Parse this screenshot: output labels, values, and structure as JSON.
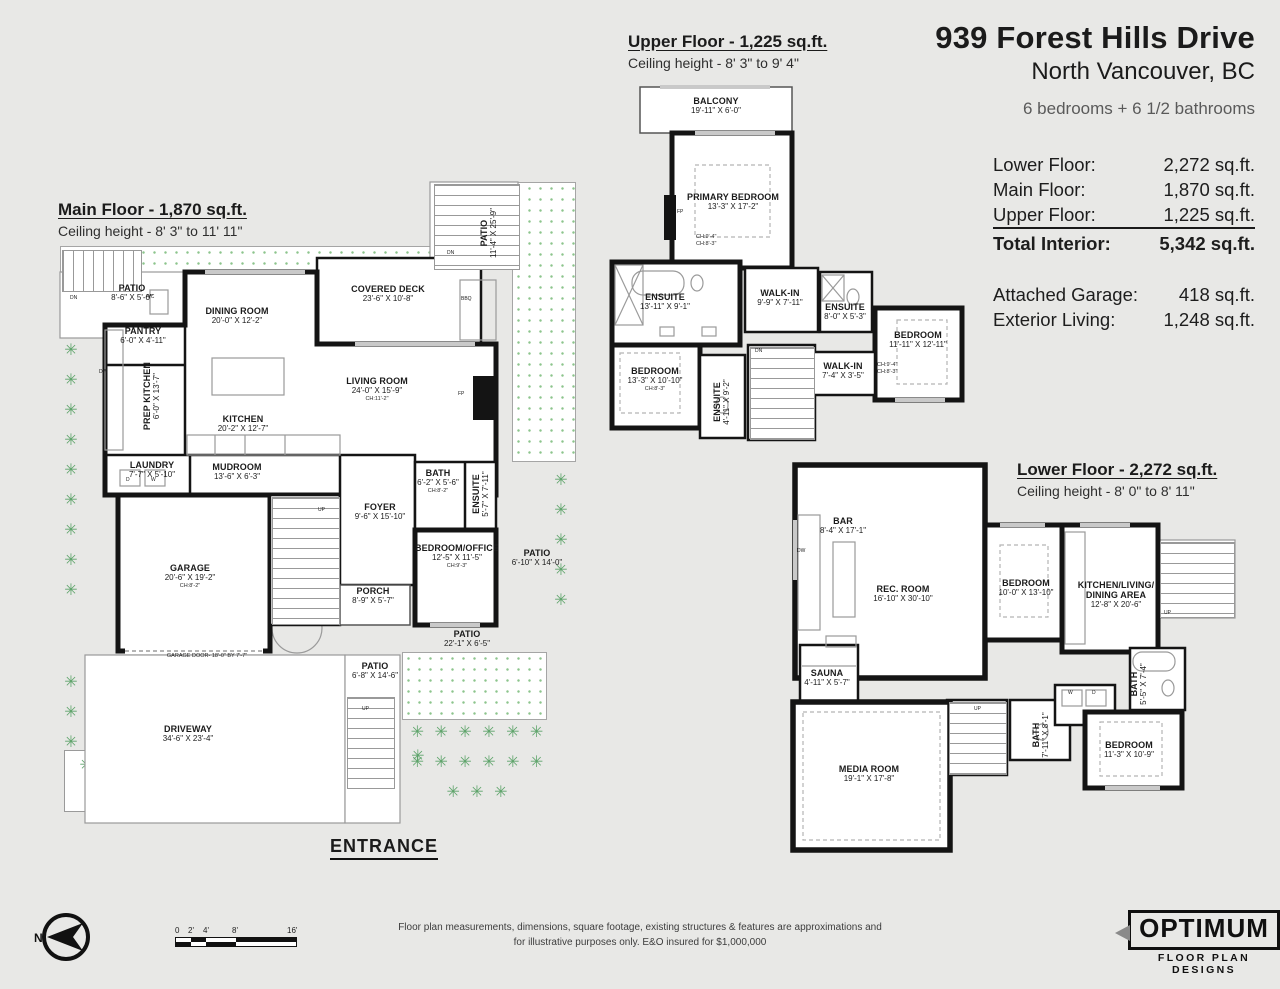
{
  "title": {
    "address": "939 Forest Hills Drive",
    "city": "North Vancouver, BC",
    "summary": "6 bedrooms + 6 1/2 bathrooms"
  },
  "area_table": {
    "rows": [
      {
        "label": "Lower Floor:",
        "value": "2,272 sq.ft."
      },
      {
        "label": "Main Floor:",
        "value": "1,870 sq.ft."
      },
      {
        "label": "Upper Floor:",
        "value": "1,225 sq.ft."
      }
    ],
    "total": {
      "label": "Total Interior:",
      "value": "5,342 sq.ft."
    },
    "extras": [
      {
        "label": "Attached Garage:",
        "value": "418 sq.ft."
      },
      {
        "label": "Exterior Living:",
        "value": "1,248 sq.ft."
      }
    ]
  },
  "floors": {
    "main": {
      "heading": "Main Floor - 1,870 sq.ft.",
      "ceiling": "Ceiling height - 8' 3\" to 11' 11\"",
      "entrance": "ENTRANCE",
      "notes": {
        "garage_door": "GARAGE DOOR- 18'-0\" BY 7'-7\""
      },
      "rooms": [
        {
          "name": "PATIO",
          "dims": "8'-6\" X 5'-0\""
        },
        {
          "name": "DINING ROOM",
          "dims": "20'-0\" X 12'-2\""
        },
        {
          "name": "COVERED DECK",
          "dims": "23'-6\" X 10'-8\""
        },
        {
          "name": "PANTRY",
          "dims": "6'-0\" X 4'-11\""
        },
        {
          "name": "PREP KITCHEN",
          "dims": "6'-0\" X 13'-7\""
        },
        {
          "name": "KITCHEN",
          "dims": "20'-2\" X 12'-7\""
        },
        {
          "name": "LIVING ROOM",
          "dims": "24'-0\" X 15'-9\"",
          "ch": "CH:11'-2\""
        },
        {
          "name": "PATIO",
          "dims": "11'-4\" X 25'-9\""
        },
        {
          "name": "LAUNDRY",
          "dims": "7'-7\" X 5'-10\""
        },
        {
          "name": "MUDROOM",
          "dims": "13'-6\" X 6'-3\""
        },
        {
          "name": "BATH",
          "dims": "6'-2\" X 5'-6\"",
          "ch": "CH:8'-2\""
        },
        {
          "name": "ENSUITE",
          "dims": "5'-7\" X 7'-11\""
        },
        {
          "name": "FOYER",
          "dims": "9'-6\" X 15'-10\""
        },
        {
          "name": "GARAGE",
          "dims": "20'-6\" X 19'-2\"",
          "ch": "CH:8'-2\""
        },
        {
          "name": "BEDROOM/OFFICE",
          "dims": "12'-5\" X 11'-5\"",
          "ch": "CH:9'-3\""
        },
        {
          "name": "PATIO",
          "dims": "6'-10\" X 14'-0\""
        },
        {
          "name": "PORCH",
          "dims": "8'-9\" X 5'-7\""
        },
        {
          "name": "PATIO",
          "dims": "22'-1\" X 6'-5\""
        },
        {
          "name": "PATIO",
          "dims": "6'-8\" X 14'-6\""
        },
        {
          "name": "DRIVEWAY",
          "dims": "34'-6\" X 23'-4\""
        }
      ]
    },
    "upper": {
      "heading": "Upper Floor - 1,225 sq.ft.",
      "ceiling": "Ceiling height - 8' 3\" to 9' 4\"",
      "rooms": [
        {
          "name": "BALCONY",
          "dims": "19'-11\" X 6'-0\""
        },
        {
          "name": "PRIMARY BEDROOM",
          "dims": "13'-3\" X 17'-2\"",
          "ch": "CH:9'-4\"",
          "ch2": "CH:8'-3\""
        },
        {
          "name": "ENSUITE",
          "dims": "13'-11\" X 9'-1\""
        },
        {
          "name": "WALK-IN",
          "dims": "9'-9\" X 7'-11\""
        },
        {
          "name": "ENSUITE",
          "dims": "8'-0\" X 5'-3\""
        },
        {
          "name": "BEDROOM",
          "dims": "11'-11\" X 12'-11\"",
          "ch": "CH:9'-4\"",
          "ch2": "CH:8'-3\""
        },
        {
          "name": "BEDROOM",
          "dims": "13'-3\" X 10'-10\"",
          "ch": "CH:8'-3\""
        },
        {
          "name": "ENSUITE",
          "dims": "4'-11\" X 9'-2\""
        },
        {
          "name": "WALK-IN",
          "dims": "7'-4\" X 3'-5\""
        }
      ]
    },
    "lower": {
      "heading": "Lower Floor - 2,272 sq.ft.",
      "ceiling": "Ceiling height - 8' 0\" to 8' 11\"",
      "rooms": [
        {
          "name": "BAR",
          "dims": "8'-4\" X 17'-1\""
        },
        {
          "name": "REC. ROOM",
          "dims": "16'-10\" X 30'-10\""
        },
        {
          "name": "BEDROOM",
          "dims": "10'-0\" X 13'-10\""
        },
        {
          "name": "KITCHEN/LIVING/ DINING AREA",
          "dims": "12'-8\" X 20'-6\""
        },
        {
          "name": "SAUNA",
          "dims": "4'-11\" X 5'-7\""
        },
        {
          "name": "BATH",
          "dims": "7'-11\" X 8'-1\""
        },
        {
          "name": "BATH",
          "dims": "5'-5\" X 7'-4\""
        },
        {
          "name": "BEDROOM",
          "dims": "11'-3\" X 10'-9\""
        },
        {
          "name": "MEDIA ROOM",
          "dims": "19'-1\" X 17'-8\""
        }
      ]
    }
  },
  "fixtures": {
    "up": "UP",
    "dn": "DN",
    "fp": "FP",
    "bbq": "BBQ",
    "ac": "A/C",
    "dw": "DW",
    "washer": "W",
    "dryer": "D"
  },
  "compass": {
    "label": "N"
  },
  "scale_bar": {
    "ticks": [
      "0",
      "2'",
      "4'",
      "8'",
      "16'"
    ]
  },
  "disclaimer": {
    "line1": "Floor plan measurements, dimensions, square footage, existing structures & features are approximations and",
    "line2": "for illustrative purposes only.  E&O insured for $1,000,000"
  },
  "logo": {
    "name": "OPTIMUM",
    "tagline": "FLOOR PLAN DESIGNS"
  },
  "colors": {
    "background": "#e8e8e6",
    "wall": "#141414",
    "plant_green": "#5fa46b",
    "dot_green": "#8cc48c"
  }
}
